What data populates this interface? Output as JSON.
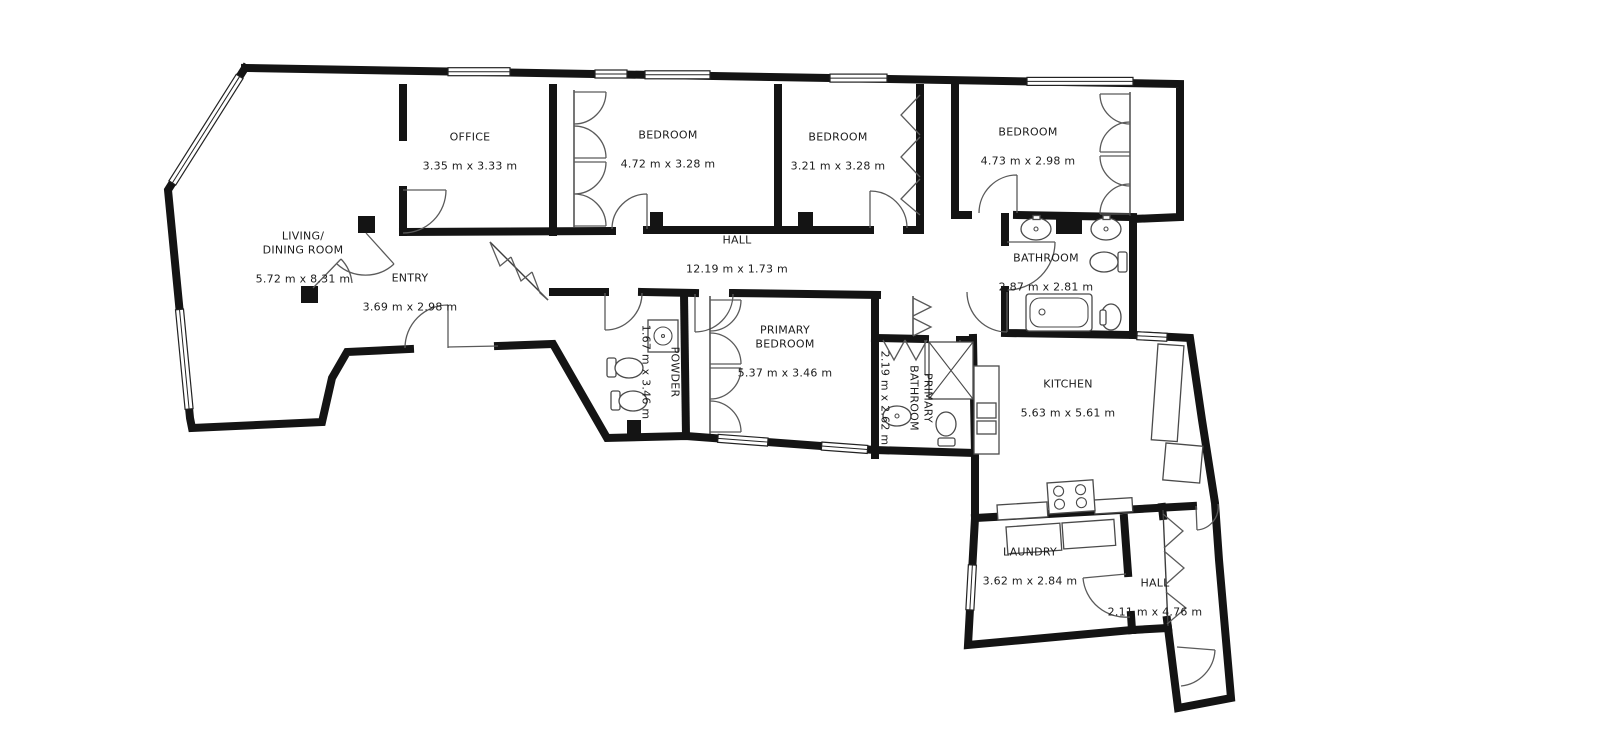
{
  "plan": {
    "type": "residential floor plan",
    "units": "m",
    "colors": {
      "wall": "#141414",
      "fixture": "#4a4a4a",
      "text": "#1c1c1c",
      "background": "#ffffff"
    }
  },
  "rooms": [
    {
      "id": "living-dining",
      "name": "LIVING/\nDINING ROOM",
      "dims": "5.72 m x 8.31 m",
      "orientation": "horizontal"
    },
    {
      "id": "office",
      "name": "OFFICE",
      "dims": "3.35 m x 3.33 m",
      "orientation": "horizontal"
    },
    {
      "id": "bedroom-1",
      "name": "BEDROOM",
      "dims": "4.72 m x 3.28 m",
      "orientation": "horizontal"
    },
    {
      "id": "bedroom-2",
      "name": "BEDROOM",
      "dims": "3.21 m x 3.28 m",
      "orientation": "horizontal"
    },
    {
      "id": "bedroom-3",
      "name": "BEDROOM",
      "dims": "4.73 m x 2.98 m",
      "orientation": "horizontal"
    },
    {
      "id": "hall-main",
      "name": "HALL",
      "dims": "12.19 m x 1.73 m",
      "orientation": "horizontal"
    },
    {
      "id": "entry",
      "name": "ENTRY",
      "dims": "3.69 m x 2.98 m",
      "orientation": "horizontal"
    },
    {
      "id": "bathroom",
      "name": "BATHROOM",
      "dims": "2.87 m x 2.81 m",
      "orientation": "horizontal"
    },
    {
      "id": "powder",
      "name": "POWDER",
      "dims": "1.67 m x 3.46 m",
      "orientation": "vertical"
    },
    {
      "id": "primary-bedroom",
      "name": "PRIMARY\nBEDROOM",
      "dims": "5.37 m x 3.46 m",
      "orientation": "horizontal"
    },
    {
      "id": "primary-bathroom",
      "name": "PRIMARY\nBATHROOM",
      "dims": "2.19 m x 2.62 m",
      "orientation": "vertical"
    },
    {
      "id": "kitchen",
      "name": "KITCHEN",
      "dims": "5.63 m x 5.61 m",
      "orientation": "horizontal"
    },
    {
      "id": "laundry",
      "name": "LAUNDRY",
      "dims": "3.62 m x 2.84 m",
      "orientation": "horizontal"
    },
    {
      "id": "hall-rear",
      "name": "HALL",
      "dims": "2.11 m x 4.76 m",
      "orientation": "horizontal"
    }
  ]
}
